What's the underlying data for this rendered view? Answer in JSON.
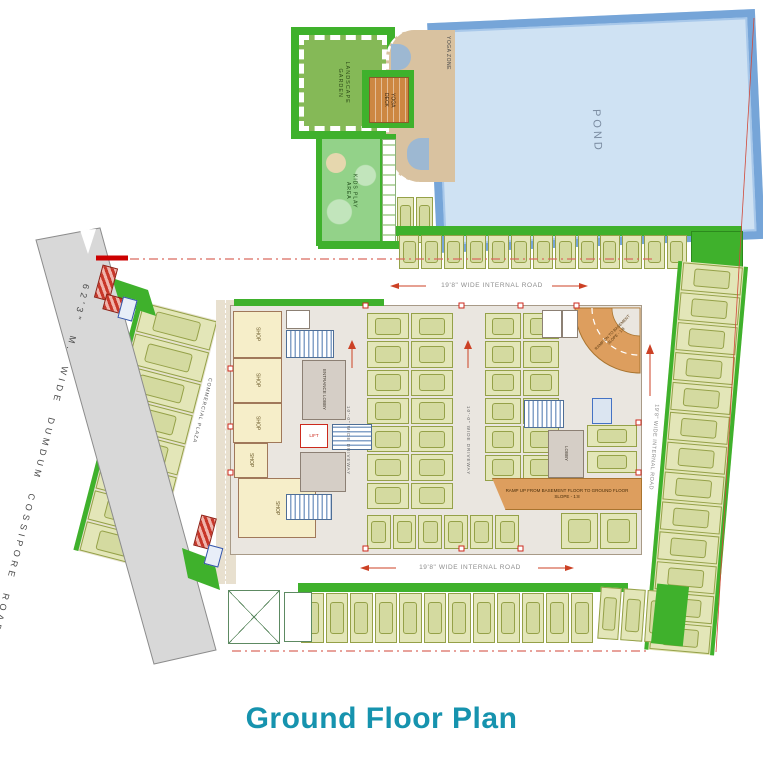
{
  "title": "Ground Floor Plan",
  "colors": {
    "title_teal": "#1693ae",
    "green": "#3fb12c",
    "pond_fill": "#cfe2f3",
    "pond_border": "#76a5d8",
    "stall_fill": "#e3e6b8",
    "stall_line": "#95a148",
    "road_gray": "#d8d8d8",
    "ramp_orange": "#dd9e5e",
    "shop_yellow": "#f6eec9",
    "accent_red": "#cc2a1d"
  },
  "amenities": {
    "landscape_garden": "LANDSCAPE GARDEN",
    "yoga_zone": "YOGA ZONE",
    "yoga_deck": "YOGA DECK",
    "kids_play_area": "KIDS PLAY AREA",
    "pond": "POND"
  },
  "roads": {
    "main_road": "62'3\" M. WIDE DUMDUM COSSIPORE ROAD",
    "internal_top": "19'8\" WIDE INTERNAL ROAD",
    "internal_bottom": "19'8\" WIDE INTERNAL ROAD",
    "internal_right": "19'8\" WIDE INTERNAL ROAD",
    "driveway_left": "10'-0\" WIDE DRIVEWAY",
    "driveway_right": "10'-0\" WIDE DRIVEWAY"
  },
  "site": {
    "commercial_plaza": "COMMERCIAL PLAZA"
  },
  "building": {
    "shop": "SHOP",
    "lift": "LIFT",
    "entrance_lobby": "ENTRANCE LOBBY",
    "lobby": "LOBBY",
    "ramp_up_line1": "RAMP UP FROM BASEMENT FLOOR TO GROUND FLOOR",
    "ramp_up_line2": "SLOPE - 1:8",
    "ramp_dn_line1": "RAMP DN TO BASEMENT",
    "ramp_dn_line2": "SLOPE - 1:8"
  }
}
